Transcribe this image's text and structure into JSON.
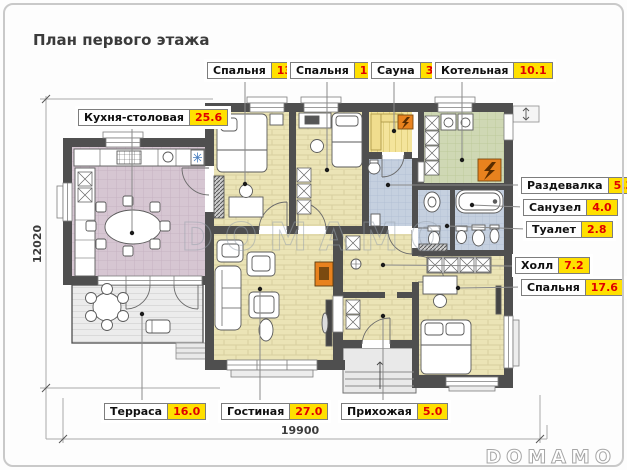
{
  "title": "План первого этажа",
  "watermark": "DOMAMO",
  "logo": "DOMAMO",
  "dimensions": {
    "width": "19900",
    "height": "12020"
  },
  "colors": {
    "wall": "#4f4f4f",
    "wood_floor": "#ebe4b6",
    "kitchen_floor": "#d6c6d2",
    "bath_floor": "#c5d0df",
    "boiler_floor": "#cfd8b4",
    "sauna_floor": "#f4e49b",
    "terrace_floor": "#ececec",
    "accent_orange": "#e8821e",
    "label_value_bg": "#ffe000",
    "label_value_text": "#e00000"
  },
  "rooms": [
    {
      "name": "Кухня-столовая",
      "area": "25.6"
    },
    {
      "name": "Спальня",
      "area": "13.5"
    },
    {
      "name": "Спальня",
      "area": "13.1"
    },
    {
      "name": "Сауна",
      "area": "3.3"
    },
    {
      "name": "Котельная",
      "area": "10.1"
    },
    {
      "name": "Раздевалка",
      "area": "5.3"
    },
    {
      "name": "Санузел",
      "area": "4.0"
    },
    {
      "name": "Туалет",
      "area": "2.8"
    },
    {
      "name": "Холл",
      "area": "7.2"
    },
    {
      "name": "Спальня",
      "area": "17.6"
    },
    {
      "name": "Терраса",
      "area": "16.0"
    },
    {
      "name": "Гостиная",
      "area": "27.0"
    },
    {
      "name": "Прихожая",
      "area": "5.0"
    }
  ]
}
